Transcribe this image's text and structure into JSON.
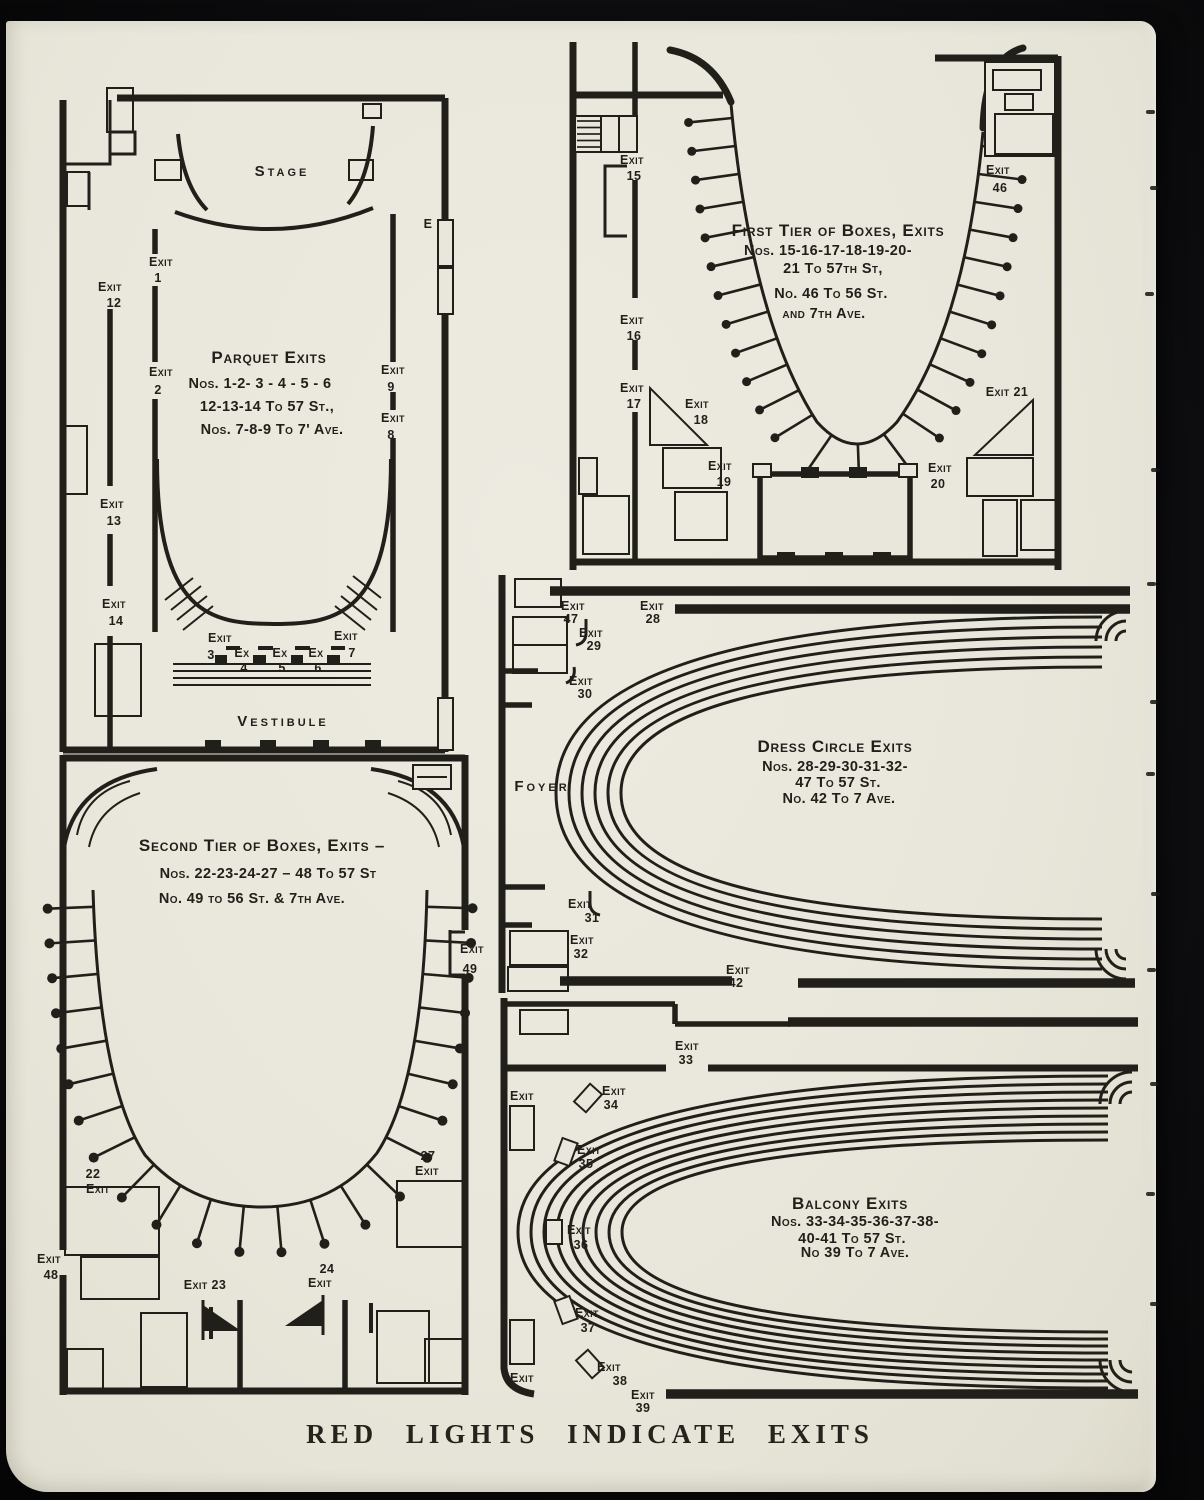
{
  "page": {
    "footer": "RED LIGHTS INDICATE EXITS"
  },
  "parquet": {
    "stage": "Stage",
    "vestibule": "Vestibule",
    "wall_letter": "E",
    "title": "Parquet Exits",
    "lines": [
      "Nos. 1-2- 3 - 4 - 5 - 6",
      "12-13-14 To 57 St.,",
      "Nos. 7-8-9 To 7' Ave."
    ],
    "exits": {
      "e1": [
        "Exit",
        "1"
      ],
      "e2": [
        "Exit",
        "2"
      ],
      "e3": [
        "Exit",
        "3"
      ],
      "e4": [
        "Ex",
        "4"
      ],
      "e5": [
        "Ex",
        "5"
      ],
      "e6": [
        "Ex",
        "6"
      ],
      "e7": [
        "Exit",
        "7"
      ],
      "e8": [
        "Exit",
        "8"
      ],
      "e9": [
        "Exit",
        "9"
      ],
      "e12": [
        "Exit",
        "12"
      ],
      "e13": [
        "Exit",
        "13"
      ],
      "e14": [
        "Exit",
        "14"
      ]
    }
  },
  "first_tier": {
    "title": "First Tier of Boxes, Exits",
    "lines": [
      "Nos. 15-16-17-18-19-20-",
      "21 To 57th St,",
      "No. 46 To 56 St.",
      "and 7th Ave."
    ],
    "exits": {
      "e15": [
        "Exit",
        "15"
      ],
      "e16": [
        "Exit",
        "16"
      ],
      "e17": [
        "Exit",
        "17"
      ],
      "e18": [
        "Exit",
        "18"
      ],
      "e19": [
        "Exit",
        "19"
      ],
      "e20": [
        "Exit",
        "20"
      ],
      "e21": [
        "Exit 21"
      ],
      "e46": [
        "Exit",
        "46"
      ]
    }
  },
  "second_tier": {
    "title": "Second Tier of Boxes, Exits –",
    "lines": [
      "Nos. 22-23-24-27 – 48 To 57 St",
      "No. 49 to 56 St. & 7th Ave."
    ],
    "exits": {
      "e22": [
        "22",
        "Exit"
      ],
      "e23": [
        "Exit 23"
      ],
      "e24": [
        "24",
        "Exit"
      ],
      "e27": [
        "27",
        "Exit"
      ],
      "e48": [
        "Exit",
        "48"
      ],
      "e49": [
        "Exit",
        "49"
      ]
    }
  },
  "dress_circle": {
    "foyer": "Foyer",
    "title": "Dress Circle Exits",
    "lines": [
      "Nos. 28-29-30-31-32-",
      "47 To 57 St.",
      "No. 42 To 7 Ave."
    ],
    "exits": {
      "e28": [
        "Exit",
        "28"
      ],
      "e29": [
        "Exit",
        "29"
      ],
      "e30": [
        "Exit",
        "30"
      ],
      "e31": [
        "Exit",
        "31"
      ],
      "e32": [
        "Exit",
        "32"
      ],
      "e42": [
        "Exit",
        "42"
      ],
      "e47": [
        "Exit",
        "47"
      ]
    }
  },
  "balcony": {
    "title": "Balcony Exits",
    "lines": [
      "Nos. 33-34-35-36-37-38-",
      "40-41 To 57 St.",
      "No 39 To 7 Ave."
    ],
    "exits": {
      "e33": [
        "Exit",
        "33"
      ],
      "e34": [
        "Exit",
        "34"
      ],
      "e35": [
        "Exit",
        "35"
      ],
      "e36": [
        "Exit",
        "36"
      ],
      "e37": [
        "Exit",
        "37"
      ],
      "e38": [
        "Exit",
        "38"
      ],
      "e39": [
        "Exit",
        "39"
      ],
      "left_top": [
        "Exit"
      ],
      "left_bottom": [
        "Exit"
      ]
    }
  }
}
